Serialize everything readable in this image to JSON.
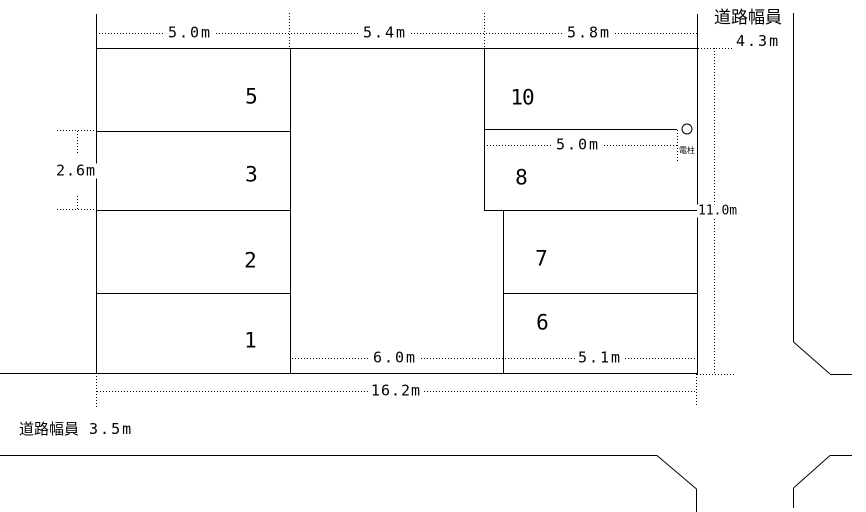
{
  "colors": {
    "line": "#000000",
    "background": "#ffffff"
  },
  "parking_spaces": [
    {
      "number": "5"
    },
    {
      "number": "3"
    },
    {
      "number": "2"
    },
    {
      "number": "1"
    },
    {
      "number": "10"
    },
    {
      "number": "8"
    },
    {
      "number": "7"
    },
    {
      "number": "6"
    }
  ],
  "dimensions": {
    "top_widths": [
      {
        "value": "5.0m"
      },
      {
        "value": "5.4m"
      },
      {
        "value": "5.8m"
      }
    ],
    "left_depth": {
      "value": "2.6m"
    },
    "pole_offset": {
      "value": "5.0m"
    },
    "site_depth": {
      "value": "11.0m"
    },
    "driveway_width": {
      "value": "6.0m"
    },
    "lower_block_width": {
      "value": "5.1m"
    },
    "total_width": {
      "value": "16.2m"
    }
  },
  "roads": {
    "right": {
      "label": "道路幅員",
      "width": "4.3m"
    },
    "bottom": {
      "label": "道路幅員",
      "width": "3.5m"
    }
  },
  "utility_pole": {
    "label": "電柱"
  }
}
